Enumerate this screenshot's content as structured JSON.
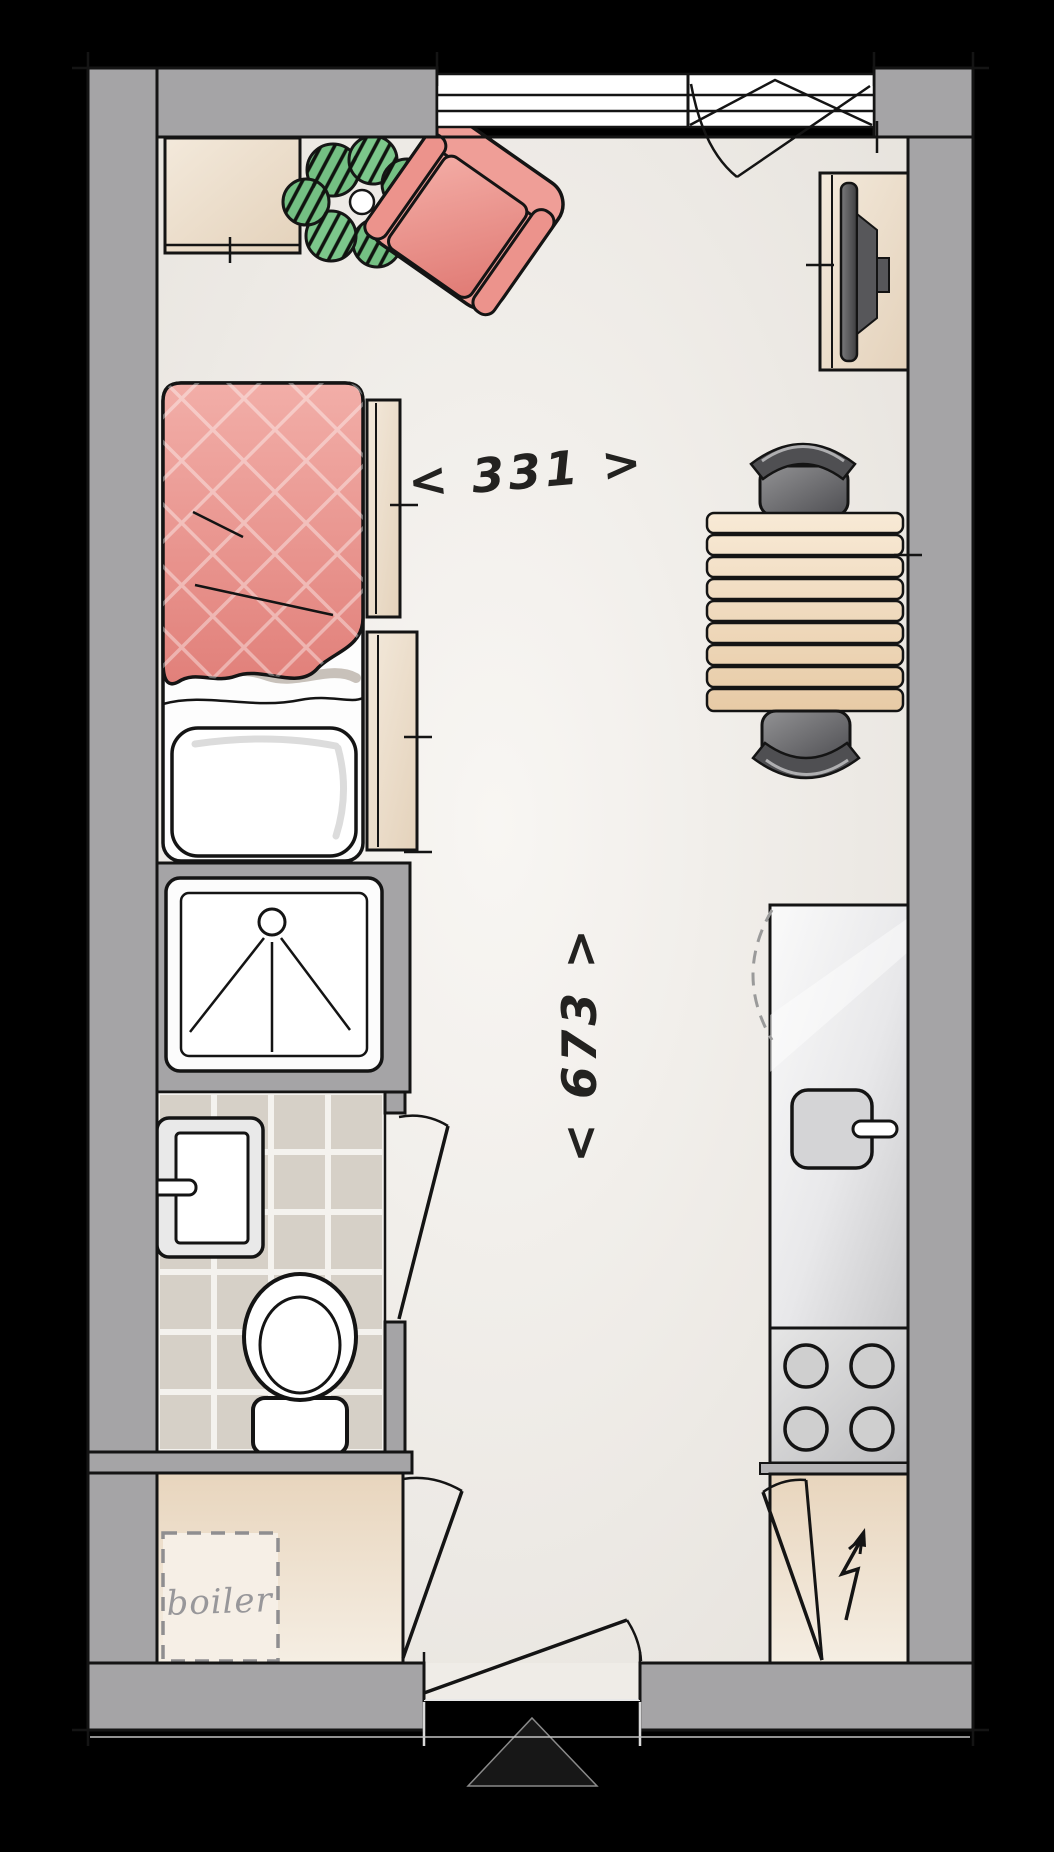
{
  "labels": {
    "width_dimension": "< 331 >",
    "height_dimension": "< 673 >",
    "boiler": "boiler"
  },
  "dimensions": {
    "room_width": 331,
    "room_depth": 673
  },
  "colors": {
    "background": "#000000",
    "wall": "#a5a4a6",
    "floor": "#f1eeea",
    "bed_duvet": "#e8938d",
    "armchair": "#ef9e97",
    "plant": "#74c083",
    "wood_table": "#f0dcbe",
    "tile": "#d6d0c7",
    "closet_floor": "#f0e2cd",
    "chair": "#6f6f71",
    "dimension_text": "#232220",
    "boiler_text": "#98979a"
  }
}
